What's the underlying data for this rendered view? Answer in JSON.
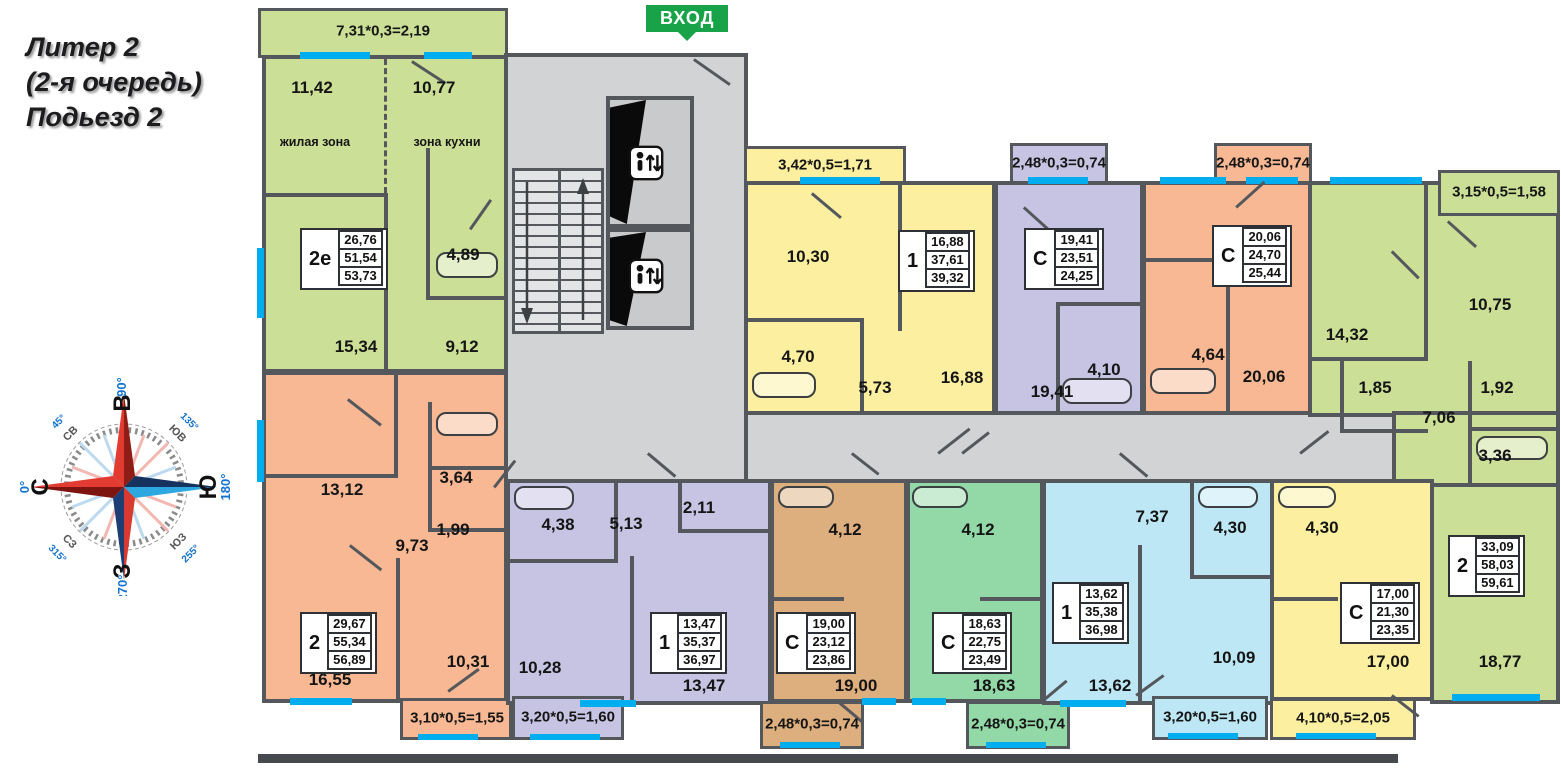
{
  "title": {
    "line1": "Литер 2",
    "line2": "(2-я очередь)",
    "line3": "Подьезд 2"
  },
  "entrance": {
    "label": "ВХОД"
  },
  "compass": {
    "n": {
      "label": "С",
      "deg": "0°"
    },
    "e": {
      "label": "В",
      "deg": "90°"
    },
    "s": {
      "label": "Ю",
      "deg": "180°"
    },
    "w": {
      "label": "З",
      "deg": "270°"
    },
    "ne": {
      "label": "СВ",
      "deg": "45°"
    },
    "se": {
      "label": "ЮВ",
      "deg": "135°"
    },
    "sw": {
      "label": "ЮЗ",
      "deg": "255°"
    },
    "nw": {
      "label": "СЗ",
      "deg": "315°"
    }
  },
  "apartments": {
    "a2e": {
      "type": "2е",
      "stats": [
        "26,76",
        "51,54",
        "53,73"
      ],
      "balcony": "7,31*0,3=2,19",
      "rooms": {
        "living": "11,42",
        "living_zone": "жилая зона",
        "kitchen": "10,77",
        "kitchen_zone": "зона кухни",
        "bath": "4,89",
        "room2": "15,34",
        "hall": "9,12"
      }
    },
    "a1y": {
      "type": "1",
      "stats": [
        "16,88",
        "37,61",
        "39,32"
      ],
      "balcony": "3,42*0,5=1,71",
      "rooms": {
        "kitchen": "10,30",
        "bath": "4,70",
        "hall": "5,73",
        "living": "16,88"
      }
    },
    "asp": {
      "type": "С",
      "stats": [
        "19,41",
        "23,51",
        "24,25"
      ],
      "balcony": "2,48*0,3=0,74",
      "rooms": {
        "main": "19,41",
        "bath": "4,10"
      }
    },
    "aso": {
      "type": "С",
      "stats": [
        "20,06",
        "24,70",
        "25,44"
      ],
      "balcony": "2,48*0,3=0,74",
      "rooms": {
        "bath": "4,64",
        "main": "20,06"
      }
    },
    "a2g": {
      "type": "2",
      "stats": [
        "33,09",
        "58,03",
        "59,61"
      ],
      "balcony": "3,15*0,5=1,58",
      "rooms": {
        "bedroom": "14,32",
        "kitchen": "10,75",
        "closet": "1,85",
        "hall": "7,06",
        "wc": "1,92",
        "bath": "3,36",
        "living": "18,77"
      }
    },
    "a2o": {
      "type": "2",
      "stats": [
        "29,67",
        "55,34",
        "56,89"
      ],
      "balcony": "3,10*0,5=1,55",
      "rooms": {
        "bedroom": "13,12",
        "bath": "3,64",
        "wc": "1,99",
        "hall": "9,73",
        "living": "16,55",
        "kitchen": "10,31"
      }
    },
    "a1p": {
      "type": "1",
      "stats": [
        "13,47",
        "35,37",
        "36,97"
      ],
      "balcony": "3,20*0,5=1,60",
      "rooms": {
        "bath": "4,38",
        "hall": "5,13",
        "closet": "2,11",
        "kitchen": "10,28",
        "living": "13,47"
      }
    },
    "asb": {
      "type": "С",
      "stats": [
        "19,00",
        "23,12",
        "23,86"
      ],
      "balcony": "2,48*0,3=0,74",
      "rooms": {
        "bath": "4,12",
        "main": "19,00"
      }
    },
    "asg": {
      "type": "С",
      "stats": [
        "18,63",
        "22,75",
        "23,49"
      ],
      "balcony": "2,48*0,3=0,74",
      "rooms": {
        "bath": "4,12",
        "main": "18,63"
      }
    },
    "a1b": {
      "type": "1",
      "stats": [
        "13,62",
        "35,38",
        "36,98"
      ],
      "balcony": "3,20*0,5=1,60",
      "rooms": {
        "hall": "7,37",
        "bath": "4,30",
        "kitchen": "10,09",
        "living": "13,62"
      }
    },
    "asy": {
      "type": "С",
      "stats": [
        "17,00",
        "21,30",
        "23,35"
      ],
      "balcony": "4,10*0,5=2,05",
      "rooms": {
        "bath": "4,30",
        "main": "17,00"
      }
    }
  },
  "palette": {
    "wall": "#54585c",
    "corridor": "#d2d3d4",
    "window": "#00aeef",
    "entrance_badge": "#18a349",
    "apt_green": "#cbdf96",
    "apt_yellow": "#fcf0a0",
    "apt_purple": "#c7c3e2",
    "apt_salmon": "#f7b893",
    "apt_tan": "#ddae7e",
    "apt_mint": "#93d8a7",
    "apt_blue": "#bde7f5"
  }
}
